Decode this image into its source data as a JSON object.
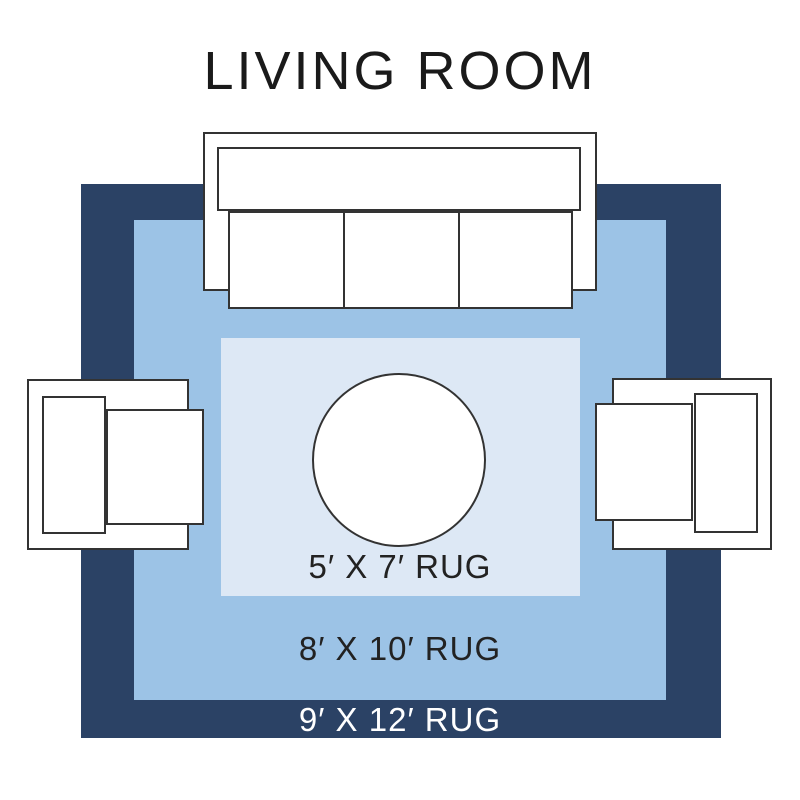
{
  "title": "LIVING ROOM",
  "rugs": [
    {
      "size": "9x12",
      "label": "9′ X 12′ RUG",
      "fill": "#2b4265",
      "label_color": "#ffffff"
    },
    {
      "size": "8x10",
      "label": "8′ X 10′ RUG",
      "fill": "#9cc3e6",
      "label_color": "#222222"
    },
    {
      "size": "5x7",
      "label": "5′ X 7′ RUG",
      "fill": "#dde8f5",
      "label_color": "#222222"
    }
  ],
  "colors": {
    "background": "#ffffff",
    "furniture_fill": "#ffffff",
    "furniture_outline": "#333333",
    "title_text": "#1a1a1a"
  }
}
